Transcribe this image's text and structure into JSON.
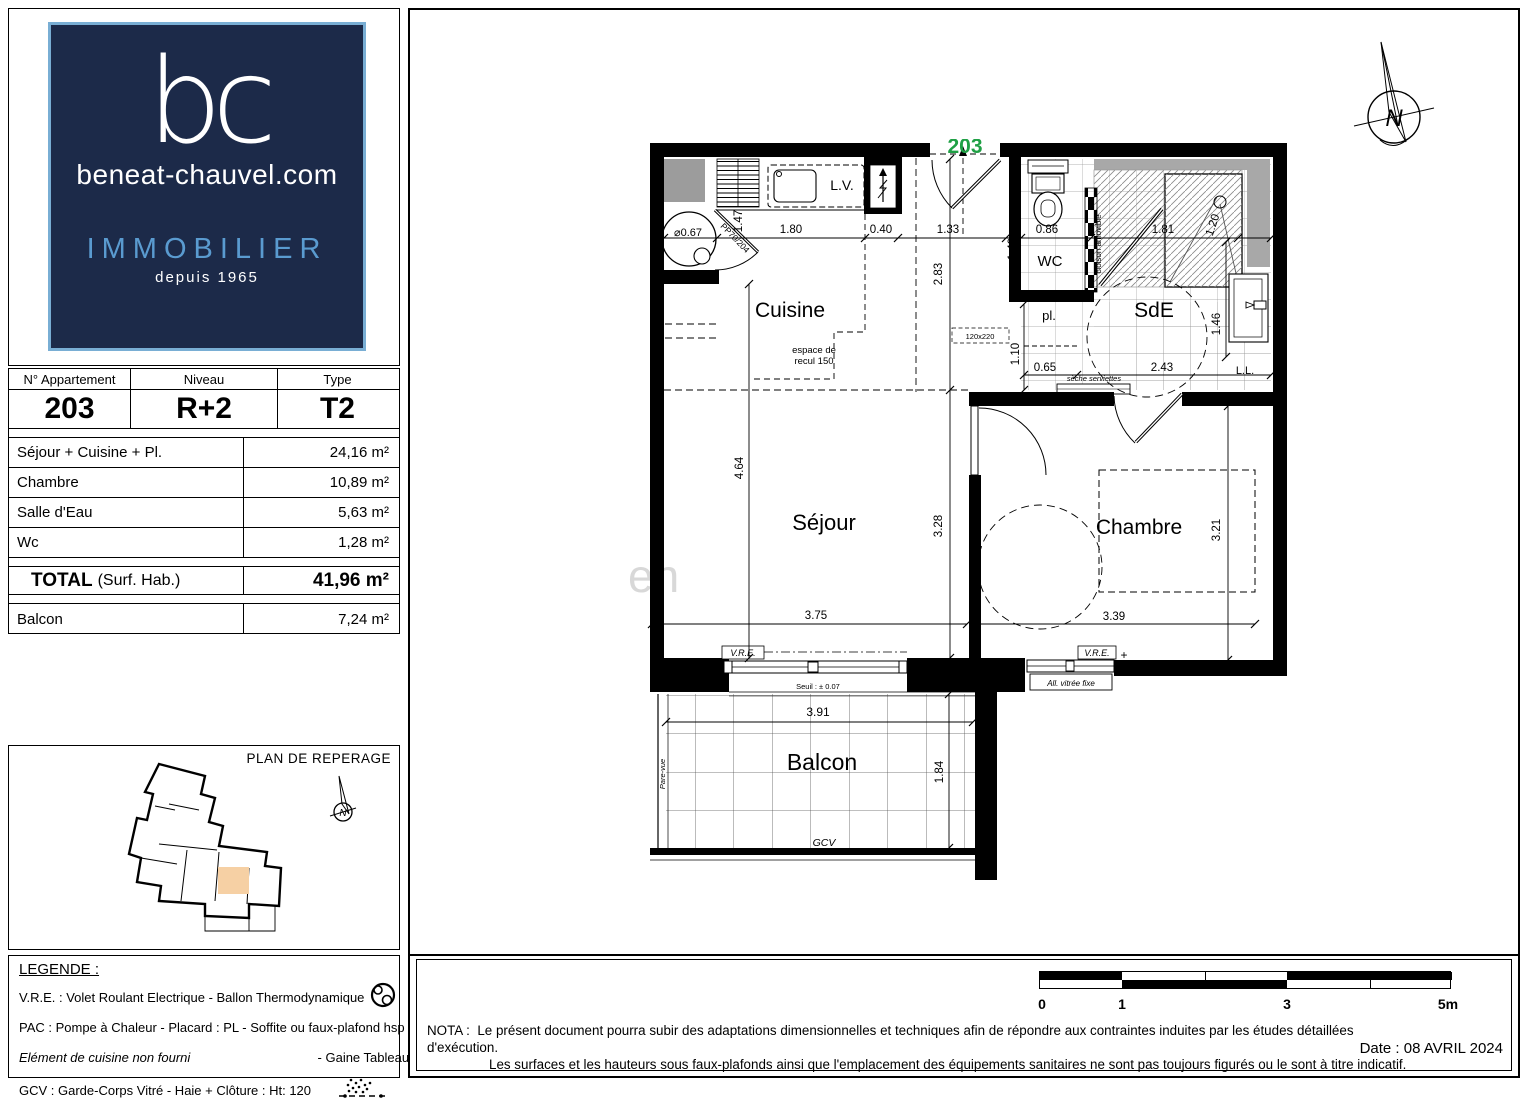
{
  "brand": {
    "initials": "bc",
    "domain": "beneat-chauvel.com",
    "tagline": "IMMOBILIER",
    "since": "depuis 1965"
  },
  "apartment": {
    "col1_header": "N° Appartement",
    "col2_header": "Niveau",
    "col3_header": "Type",
    "number": "203",
    "level": "R+2",
    "type": "T2"
  },
  "surfaces": {
    "rows": [
      {
        "label": "Séjour + Cuisine + Pl.",
        "value": "24,16 m²"
      },
      {
        "label": "Chambre",
        "value": "10,89 m²"
      },
      {
        "label": "Salle d'Eau",
        "value": "5,63 m²"
      },
      {
        "label": "Wc",
        "value": "1,28 m²"
      }
    ],
    "total_label": "TOTAL",
    "total_note": "(Surf. Hab.)",
    "total_value": "41,96 m²",
    "balcon_label": "Balcon",
    "balcon_value": "7,24 m²"
  },
  "reperage": {
    "title": "PLAN DE REPERAGE",
    "highlight_color": "#f6d0a4"
  },
  "legend": {
    "title": "LEGENDE :",
    "rows": [
      {
        "text": "V.R.E. :  Volet Roulant Electrique   -   Ballon Thermodynamique",
        "icon": "ballon-thermodynamique-icon"
      },
      {
        "text": "PAC : Pompe à Chaleur  - Placard :  PL  - Soffite ou faux-plafond hsp ~230",
        "icon": "soffite-hatch-icon"
      },
      {
        "text_italic": "Elément de cuisine non fourni",
        "text": "-   Gaine Tableau Electrique",
        "icon": "gaine-tableau-icon"
      },
      {
        "text": "GCV : Garde-Corps Vitré  -  Haie + Clôture : Ht: 120",
        "icon": "haie-cloture-icon"
      }
    ]
  },
  "plan": {
    "unit_number": "203",
    "unit_color": "#1fa045",
    "watermark_fragment": "en",
    "rooms": {
      "cuisine": "Cuisine",
      "sejour": "Séjour",
      "chambre": "Chambre",
      "sde": "SdE",
      "wc": "WC",
      "balcon": "Balcon",
      "placard": "pl."
    },
    "dims": {
      "k_width": "1.80",
      "k_gaine": "0.40",
      "hall_w": "1.33",
      "wc_w": "0.86",
      "shower_w": "1.81",
      "shower_d": "1.20",
      "k_depth": "1.47",
      "hall_d": "2.83",
      "wc_d": "1.49",
      "pl_d": "1.10",
      "pl_w": "0.65",
      "sde_w": "2.43",
      "vanity_d": "1.46",
      "sejour_h": "4.64",
      "sejour_h2": "3.28",
      "sejour_w": "3.75",
      "chambre_w": "3.39",
      "chambre_h": "3.21",
      "balcon_w": "3.91",
      "balcon_d": "1.84"
    },
    "annotations": {
      "lv": "L.V.",
      "ll": "L.L.",
      "vre_sejour": "V.R.E.",
      "vre_chambre": "V.R.E.",
      "seuil": "Seuil : ± 0.07",
      "allege": "All. vitrée fixe",
      "recul_1": "espace de",
      "recul_2": "recul 150",
      "ballon_dia": "⌀0.67",
      "porte": "PP70/204",
      "cloison": "cloison amovible",
      "seche": "sèche serviettes",
      "porte_fen": "120x220",
      "gcv": "GCV",
      "pare_vue": "Pare-vue",
      "north": "N",
      "plus": "+"
    }
  },
  "footer": {
    "nota_label": "NOTA :",
    "nota_line1": "Le présent document pourra subir des adaptations dimensionnelles et techniques afin de répondre aux contraintes induites par les études détaillées d'exécution.",
    "nota_line2": "Les surfaces et les hauteurs sous faux-plafonds ainsi que l'emplacement des équipements sanitaires ne sont pas toujours figurés ou le sont à titre indicatif.",
    "date": "Date : 08 AVRIL 2024",
    "scale": {
      "labels": [
        "0",
        "1",
        "3",
        "5m"
      ]
    }
  }
}
